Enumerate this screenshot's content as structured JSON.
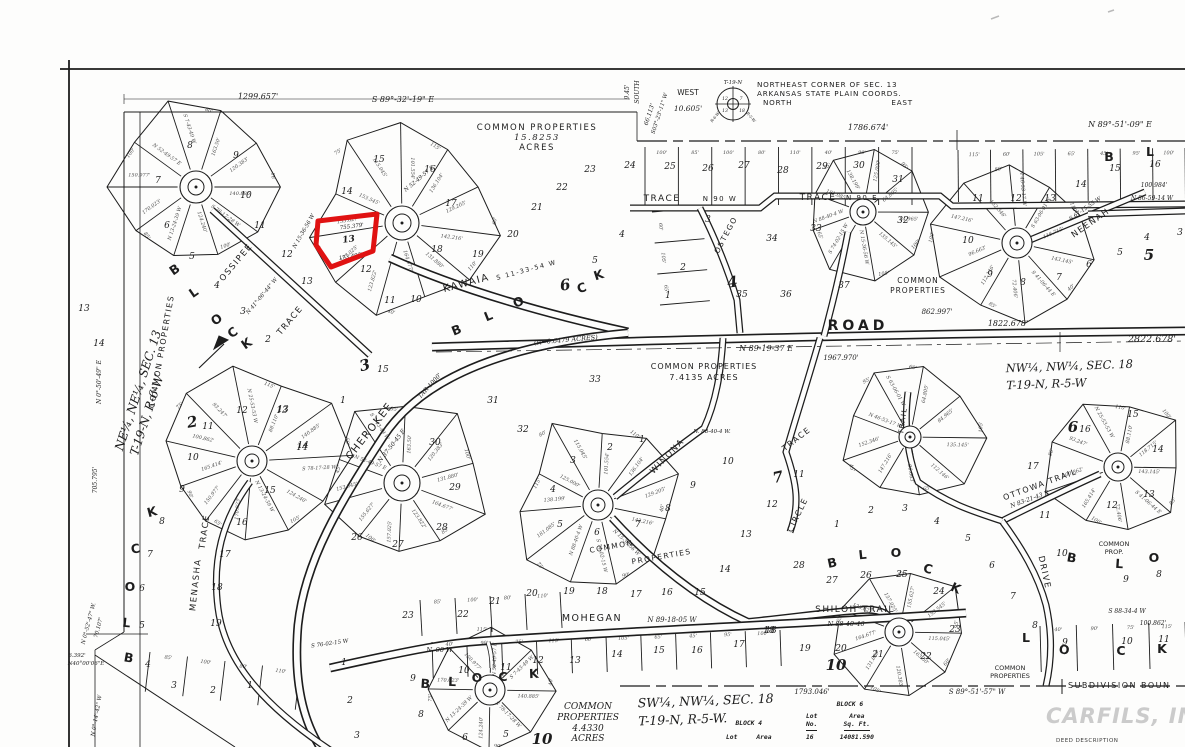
{
  "colors": {
    "paper": "#fdfdfc",
    "ink": "#1d1d1d",
    "highlight": "#e01212",
    "watermark": "#cbcbcb"
  },
  "corner_note": {
    "l1": "NORTHEAST CORNER OF SEC. 13",
    "l2": "ARKANSAS STATE PLAIN COORDS.",
    "north": "NORTH",
    "east": "EAST",
    "west": "WEST",
    "west_dim": "10.605'",
    "township": "T-19-N",
    "range_w": "R-6-W",
    "range_e": "R-5-W",
    "sec_nw": "12",
    "sec_ne": "7",
    "sec_sw": "13",
    "sec_se": "18"
  },
  "sections": {
    "ne": {
      "l1": "NE¼, NE¼, SEC. 13",
      "l2": "T-19-N, R-6-W"
    },
    "nw": {
      "l1": "NW¼, NW¼, SEC. 18",
      "l2": "T-19-N, R-5-W"
    },
    "sw": {
      "l1": "SW¼, NW¼, SEC. 18",
      "l2": "T-19-N, R-5-W."
    }
  },
  "common_properties": {
    "main": [
      "COMMON PROPERTIES",
      "15.8253",
      "ACRES"
    ],
    "mid": [
      "COMMON PROPERTIES",
      "7.4135 ACRES"
    ],
    "south": [
      "COMMON",
      "PROPERTIES",
      "4.4330",
      "ACRES"
    ],
    "block4": [
      "COMMON",
      "PROPERTIES"
    ],
    "right_small": [
      "COMMON",
      "PROP."
    ],
    "bottom_right": [
      "COMMON",
      "PROPERTIES"
    ]
  },
  "tables": {
    "block4": {
      "title": "BLOCK 4",
      "col_lot": "Lot",
      "col_area": "Area"
    },
    "block6": {
      "title": "BLOCK 6",
      "col_lot_1": "Lot",
      "col_lot_2": "No.",
      "col_area_1": "Area",
      "col_area_2": "Sq. Ft.",
      "row_no": "16",
      "row_area": "14081.590"
    }
  },
  "boundary": {
    "label": "SUBDIVISION BOUN"
  },
  "watermark": {
    "brand": "CARFILS, INC",
    "sub": "DEED DESCRIPTION"
  },
  "highlight": {
    "lot": "13",
    "color": "#e01212",
    "points": "318,221 377,214 373,251 331,267 316,245",
    "label_x": 349,
    "label_y": 242,
    "label_rot": -8
  },
  "map_texts": [
    {
      "t": "TRACE",
      "x": 662,
      "y": 201,
      "s": 9,
      "c": "st"
    },
    {
      "t": "N 90 W",
      "x": 720,
      "y": 201,
      "s": 7,
      "c": "st"
    },
    {
      "t": "TRACE",
      "x": 818,
      "y": 200,
      "s": 9,
      "c": "st"
    },
    {
      "t": "N 90 E",
      "x": 862,
      "y": 200,
      "s": 7,
      "c": "st"
    },
    {
      "t": "OSTEGO",
      "x": 728,
      "y": 236,
      "r": -62,
      "s": 7.5,
      "c": "st"
    },
    {
      "t": "KAWAIA",
      "x": 467,
      "y": 286,
      "r": -15,
      "s": 10,
      "c": "st"
    },
    {
      "t": "S 11-33-54 W",
      "x": 527,
      "y": 272,
      "r": -15,
      "s": 6.5,
      "c": "st"
    },
    {
      "t": "ROAD",
      "x": 858,
      "y": 330,
      "s": 14,
      "c": "stb"
    },
    {
      "t": "N 89-19-37 E",
      "x": 766,
      "y": 351,
      "s": 8,
      "c": "dim"
    },
    {
      "t": "CHEROKEE",
      "x": 372,
      "y": 433,
      "r": -52,
      "s": 10.5,
      "c": "st"
    },
    {
      "t": "N 37-50-45 E",
      "x": 393,
      "y": 447,
      "r": -52,
      "s": 6,
      "c": "dim"
    },
    {
      "t": "OSSIPEE",
      "x": 238,
      "y": 264,
      "r": -50,
      "s": 8.5,
      "c": "st"
    },
    {
      "t": "TRACE",
      "x": 292,
      "y": 322,
      "r": -50,
      "s": 8.5,
      "c": "st"
    },
    {
      "t": "MENASHA",
      "x": 198,
      "y": 585,
      "r": -84,
      "s": 8.5,
      "c": "st"
    },
    {
      "t": "TRACE",
      "x": 207,
      "y": 532,
      "r": -82,
      "s": 8.5,
      "c": "st"
    },
    {
      "t": "WINONA",
      "x": 669,
      "y": 458,
      "r": -46,
      "s": 8.5,
      "c": "st"
    },
    {
      "t": "TRACE",
      "x": 798,
      "y": 441,
      "r": -38,
      "s": 8,
      "c": "st"
    },
    {
      "t": "CIRCLE",
      "x": 800,
      "y": 516,
      "r": -64,
      "s": 8,
      "c": "st"
    },
    {
      "t": "TRAIL",
      "x": 905,
      "y": 421,
      "r": -82,
      "s": 7,
      "c": "st"
    },
    {
      "t": "NEENAH",
      "x": 1092,
      "y": 225,
      "r": -35,
      "s": 8.5,
      "c": "st"
    },
    {
      "t": "S 67-15-55 W",
      "x": 1086,
      "y": 210,
      "r": -35,
      "s": 5.5,
      "c": "dim"
    },
    {
      "t": "MOHEGAN",
      "x": 592,
      "y": 621,
      "s": 9.5,
      "c": "st"
    },
    {
      "t": "N 89-18-05 W",
      "x": 672,
      "y": 622,
      "s": 7,
      "c": "dim"
    },
    {
      "t": "SHILOH TRAIL",
      "x": 855,
      "y": 612,
      "s": 9,
      "c": "st"
    },
    {
      "t": "N 88-40-46",
      "x": 846,
      "y": 626,
      "s": 6.5,
      "c": "dim"
    },
    {
      "t": "OTTOWA TRAIL",
      "x": 1041,
      "y": 487,
      "r": -20,
      "s": 8,
      "c": "st"
    },
    {
      "t": "N 83-21-43 E",
      "x": 1030,
      "y": 501,
      "r": -20,
      "s": 6,
      "c": "dim"
    },
    {
      "t": "DRIVE",
      "x": 1042,
      "y": 573,
      "r": 78,
      "s": 8.5,
      "c": "st"
    },
    {
      "t": "1299.657'",
      "x": 258,
      "y": 99,
      "s": 8,
      "c": "dim"
    },
    {
      "t": "S 89°-32'-19\" E",
      "x": 403,
      "y": 102,
      "s": 8,
      "c": "dim"
    },
    {
      "t": "1786.674'",
      "x": 868,
      "y": 130,
      "s": 8,
      "c": "dim"
    },
    {
      "t": "N 89°-51'-09\" E",
      "x": 1120,
      "y": 127,
      "s": 8,
      "c": "dim"
    },
    {
      "t": "9.45'",
      "x": 629,
      "y": 92,
      "r": -90,
      "s": 6,
      "c": "dim"
    },
    {
      "t": "SOUTH",
      "x": 639,
      "y": 92,
      "r": -90,
      "s": 6,
      "c": "dim"
    },
    {
      "t": "66.113'",
      "x": 651,
      "y": 115,
      "r": -72,
      "s": 6,
      "c": "dim"
    },
    {
      "t": "S03°-23'-11\" W",
      "x": 661,
      "y": 114,
      "r": -72,
      "s": 5.5,
      "c": "dim"
    },
    {
      "t": "(R=0.6479 ACRES)",
      "x": 566,
      "y": 342,
      "r": -5,
      "s": 6.5,
      "c": "dim"
    },
    {
      "t": "862.997'",
      "x": 937,
      "y": 314,
      "s": 7,
      "c": "dim"
    },
    {
      "t": "1822.678'",
      "x": 1008,
      "y": 326,
      "s": 8,
      "c": "dim"
    },
    {
      "t": "2822.678'",
      "x": 1152,
      "y": 342,
      "s": 9.5,
      "c": "dim"
    },
    {
      "t": "1967.970'",
      "x": 841,
      "y": 360,
      "s": 7,
      "c": "dim"
    },
    {
      "t": "TAR-1000'",
      "x": 431,
      "y": 387,
      "r": -48,
      "s": 6,
      "c": "dim"
    },
    {
      "t": "N 86-59-14 W",
      "x": 1152,
      "y": 200,
      "s": 6,
      "c": "dim"
    },
    {
      "t": "100.984'",
      "x": 1154,
      "y": 187,
      "s": 6,
      "c": "dim"
    },
    {
      "t": "S 88-34-4 W",
      "x": 1127,
      "y": 613,
      "s": 6,
      "c": "dim"
    },
    {
      "t": "100.862'",
      "x": 1153,
      "y": 625,
      "s": 6,
      "c": "dim"
    },
    {
      "t": "1793.046'",
      "x": 812,
      "y": 694,
      "s": 7,
      "c": "dim"
    },
    {
      "t": "S 89°-51'-57\" W",
      "x": 977,
      "y": 694,
      "s": 7,
      "c": "dim"
    },
    {
      "t": "N 0°-50'-49\" E",
      "x": 101,
      "y": 382,
      "r": -90,
      "s": 6,
      "c": "dim"
    },
    {
      "t": "705.795'",
      "x": 97,
      "y": 480,
      "r": -90,
      "s": 6,
      "c": "dim"
    },
    {
      "t": "6.392'",
      "x": 77,
      "y": 657,
      "s": 5.5,
      "c": "dim"
    },
    {
      "t": "N40°00'06\"E",
      "x": 86,
      "y": 665,
      "s": 5.5,
      "c": "dim"
    },
    {
      "t": "N 0°-52'-47\" W.",
      "x": 90,
      "y": 624,
      "r": -75,
      "s": 5.5,
      "c": "dim"
    },
    {
      "t": "70.107'",
      "x": 100,
      "y": 628,
      "r": -75,
      "s": 5.5,
      "c": "dim"
    },
    {
      "t": "N 0°-14'-42\" W",
      "x": 98,
      "y": 716,
      "r": -80,
      "s": 5.5,
      "c": "dim"
    },
    {
      "t": "755.379'",
      "x": 352,
      "y": 228,
      "r": -7,
      "s": 5.5,
      "c": "dim"
    },
    {
      "t": "173.495'",
      "x": 351,
      "y": 258,
      "r": -9,
      "s": 5.5,
      "c": "dim"
    },
    {
      "t": "N. 90 W.",
      "x": 440,
      "y": 652,
      "s": 6.5,
      "c": "dim"
    },
    {
      "t": "S 76-02-15 W",
      "x": 330,
      "y": 645,
      "r": -8,
      "s": 5.5,
      "c": "dim"
    },
    {
      "t": "N 41°-06'-44\" W",
      "x": 263,
      "y": 297,
      "r": -50,
      "s": 5.5,
      "c": "dim"
    },
    {
      "t": "N 15-36-56 W",
      "x": 305,
      "y": 232,
      "r": -60,
      "s": 5.5,
      "c": "dim"
    },
    {
      "t": "N 52-49-57 E",
      "x": 420,
      "y": 180,
      "r": -40,
      "s": 5.5,
      "c": "dim"
    },
    {
      "t": "N. 88-40-4 W.",
      "x": 712,
      "y": 433,
      "s": 5.5,
      "c": "dim"
    },
    {
      "t": "COMMON",
      "x": 612,
      "y": 549,
      "r": -10,
      "s": 7.5,
      "c": "st"
    },
    {
      "t": "PROPERTIES",
      "x": 662,
      "y": 559,
      "r": -10,
      "s": 7.5,
      "c": "st"
    },
    {
      "t": "COMMON PROPERTIES",
      "x": 164,
      "y": 352,
      "r": -80,
      "s": 8,
      "c": "st"
    }
  ],
  "lot_numbers": [
    [
      8,
      190,
      148
    ],
    [
      9,
      236,
      158
    ],
    [
      7,
      158,
      183
    ],
    [
      10,
      246,
      198
    ],
    [
      6,
      167,
      228
    ],
    [
      11,
      260,
      228
    ],
    [
      5,
      192,
      259
    ],
    [
      12,
      287,
      257
    ],
    [
      4,
      217,
      288
    ],
    [
      13,
      307,
      284
    ],
    [
      3,
      243,
      314
    ],
    [
      2,
      268,
      342
    ],
    [
      13,
      84,
      311
    ],
    [
      14,
      99,
      346
    ],
    [
      15,
      379,
      162
    ],
    [
      16,
      430,
      172
    ],
    [
      14,
      347,
      194
    ],
    [
      17,
      451,
      206
    ],
    [
      12,
      366,
      272
    ],
    [
      18,
      437,
      252
    ],
    [
      11,
      390,
      303
    ],
    [
      19,
      478,
      257
    ],
    [
      20,
      513,
      237
    ],
    [
      21,
      537,
      210
    ],
    [
      22,
      562,
      190
    ],
    [
      23,
      590,
      172
    ],
    [
      10,
      416,
      302
    ],
    [
      4,
      622,
      237
    ],
    [
      5,
      595,
      263
    ],
    [
      24,
      630,
      168
    ],
    [
      25,
      670,
      169
    ],
    [
      26,
      708,
      171
    ],
    [
      27,
      744,
      168
    ],
    [
      28,
      783,
      173
    ],
    [
      29,
      822,
      169
    ],
    [
      30,
      859,
      168
    ],
    [
      31,
      898,
      182
    ],
    [
      34,
      772,
      241
    ],
    [
      33,
      816,
      231
    ],
    [
      32,
      903,
      223
    ],
    [
      35,
      742,
      297
    ],
    [
      36,
      786,
      297
    ],
    [
      37,
      844,
      288
    ],
    [
      3,
      708,
      222
    ],
    [
      2,
      683,
      270
    ],
    [
      1,
      668,
      298
    ],
    [
      11,
      978,
      201
    ],
    [
      12,
      1016,
      201
    ],
    [
      13,
      1050,
      201
    ],
    [
      14,
      1081,
      187
    ],
    [
      15,
      1115,
      171
    ],
    [
      16,
      1155,
      167
    ],
    [
      10,
      968,
      243
    ],
    [
      9,
      990,
      277
    ],
    [
      8,
      1023,
      285
    ],
    [
      7,
      1059,
      280
    ],
    [
      6,
      1089,
      267
    ],
    [
      5,
      1120,
      255
    ],
    [
      4,
      1147,
      240
    ],
    [
      3,
      1180,
      235
    ],
    [
      11,
      208,
      429
    ],
    [
      12,
      242,
      413
    ],
    [
      13,
      282,
      413
    ],
    [
      14,
      302,
      450
    ],
    [
      10,
      193,
      460
    ],
    [
      9,
      182,
      492
    ],
    [
      15,
      270,
      493
    ],
    [
      8,
      162,
      524
    ],
    [
      16,
      242,
      525
    ],
    [
      7,
      150,
      557
    ],
    [
      17,
      225,
      557
    ],
    [
      6,
      142,
      591
    ],
    [
      18,
      217,
      590
    ],
    [
      5,
      142,
      628
    ],
    [
      19,
      216,
      626
    ],
    [
      4,
      148,
      667
    ],
    [
      3,
      174,
      688
    ],
    [
      2,
      213,
      693
    ],
    [
      1,
      250,
      688
    ],
    [
      30,
      435,
      445
    ],
    [
      29,
      455,
      490
    ],
    [
      28,
      442,
      530
    ],
    [
      27,
      398,
      547
    ],
    [
      26,
      357,
      540
    ],
    [
      31,
      493,
      403
    ],
    [
      32,
      523,
      432
    ],
    [
      33,
      595,
      382
    ],
    [
      1,
      343,
      403
    ],
    [
      15,
      383,
      372
    ],
    [
      14,
      303,
      448
    ],
    [
      13,
      283,
      412
    ],
    [
      2,
      610,
      450
    ],
    [
      1,
      642,
      442
    ],
    [
      3,
      573,
      463
    ],
    [
      4,
      553,
      492
    ],
    [
      5,
      560,
      527
    ],
    [
      6,
      597,
      535
    ],
    [
      7,
      638,
      527
    ],
    [
      8,
      668,
      511
    ],
    [
      9,
      693,
      488
    ],
    [
      10,
      728,
      464
    ],
    [
      11,
      799,
      477
    ],
    [
      12,
      772,
      507
    ],
    [
      13,
      746,
      537
    ],
    [
      14,
      725,
      572
    ],
    [
      15,
      700,
      595
    ],
    [
      16,
      667,
      595
    ],
    [
      17,
      636,
      597
    ],
    [
      18,
      602,
      594
    ],
    [
      19,
      569,
      594
    ],
    [
      20,
      532,
      596
    ],
    [
      21,
      495,
      604
    ],
    [
      22,
      463,
      617
    ],
    [
      23,
      408,
      618
    ],
    [
      1,
      837,
      527
    ],
    [
      2,
      871,
      513
    ],
    [
      3,
      905,
      511
    ],
    [
      4,
      937,
      524
    ],
    [
      5,
      968,
      541
    ],
    [
      6,
      992,
      568
    ],
    [
      7,
      1013,
      599
    ],
    [
      8,
      1035,
      628
    ],
    [
      28,
      799,
      568
    ],
    [
      27,
      832,
      583
    ],
    [
      26,
      866,
      578
    ],
    [
      25,
      902,
      577
    ],
    [
      24,
      939,
      594
    ],
    [
      23,
      955,
      632
    ],
    [
      22,
      926,
      659
    ],
    [
      21,
      878,
      657
    ],
    [
      20,
      841,
      651
    ],
    [
      19,
      805,
      651
    ],
    [
      18,
      771,
      633
    ],
    [
      15,
      1133,
      417
    ],
    [
      16,
      1085,
      432
    ],
    [
      14,
      1158,
      452
    ],
    [
      17,
      1033,
      469
    ],
    [
      13,
      1149,
      497
    ],
    [
      12,
      1112,
      508
    ],
    [
      11,
      1045,
      518
    ],
    [
      10,
      1062,
      556
    ],
    [
      9,
      1126,
      582
    ],
    [
      8,
      1159,
      577
    ],
    [
      11,
      506,
      670
    ],
    [
      12,
      538,
      663
    ],
    [
      13,
      575,
      663
    ],
    [
      14,
      617,
      657
    ],
    [
      15,
      659,
      653
    ],
    [
      16,
      697,
      653
    ],
    [
      17,
      739,
      647
    ],
    [
      18,
      769,
      633
    ],
    [
      10,
      464,
      673
    ],
    [
      9,
      413,
      681
    ],
    [
      8,
      421,
      717
    ],
    [
      6,
      465,
      740
    ],
    [
      5,
      506,
      737
    ],
    [
      1,
      344,
      665
    ],
    [
      2,
      350,
      703
    ],
    [
      3,
      357,
      738
    ],
    [
      9,
      1065,
      645
    ],
    [
      10,
      1127,
      644
    ],
    [
      11,
      1164,
      642
    ]
  ],
  "block_letters": [
    [
      "B",
      177,
      273,
      -35
    ],
    [
      "L",
      196,
      296,
      -35
    ],
    [
      "O",
      219,
      323,
      -35
    ],
    [
      "C",
      235,
      336,
      -35
    ],
    [
      "K",
      249,
      347,
      -35
    ],
    [
      "K",
      153,
      516,
      -15
    ],
    [
      "C",
      136,
      553,
      -8
    ],
    [
      "O",
      130,
      591,
      0
    ],
    [
      "L",
      126,
      627,
      6
    ],
    [
      "B",
      128,
      662,
      10
    ],
    [
      "B",
      425,
      688,
      4
    ],
    [
      "L",
      452,
      686,
      2
    ],
    [
      "O",
      477,
      682,
      0
    ],
    [
      "C",
      503,
      681,
      0
    ],
    [
      "K",
      534,
      678,
      -2
    ],
    [
      "B",
      833,
      567,
      -12
    ],
    [
      "L",
      863,
      559,
      -6
    ],
    [
      "O",
      896,
      557,
      0
    ],
    [
      "C",
      927,
      573,
      14
    ],
    [
      "K",
      954,
      592,
      24
    ],
    [
      "B",
      1071,
      562,
      10
    ],
    [
      "L",
      1119,
      568,
      4
    ],
    [
      "O",
      1154,
      562,
      0
    ],
    [
      "L",
      1026,
      642,
      0
    ],
    [
      "O",
      1064,
      654,
      4
    ],
    [
      "C",
      1121,
      655,
      0
    ],
    [
      "K",
      1162,
      653,
      0
    ],
    [
      "B",
      458,
      334,
      -22
    ],
    [
      "L",
      490,
      320,
      -22
    ],
    [
      "O",
      520,
      306,
      -22
    ],
    [
      "C",
      583,
      292,
      -18
    ],
    [
      "K",
      600,
      279,
      -18
    ],
    [
      "B",
      1109,
      161,
      0
    ],
    [
      "L",
      1150,
      156,
      0
    ]
  ],
  "block_numbers": [
    [
      "3",
      366,
      370,
      -15
    ],
    [
      "4",
      733,
      287,
      -8
    ],
    [
      "5",
      1149,
      260,
      0
    ],
    [
      "6",
      1073,
      432,
      0
    ],
    [
      "6",
      566,
      290,
      -10
    ],
    [
      "7",
      779,
      482,
      -12
    ],
    [
      "10",
      836,
      670,
      0
    ],
    [
      "10",
      542,
      744,
      0
    ],
    [
      "2",
      193,
      427,
      -10
    ]
  ],
  "annotations": [
    "140.885'",
    "S 78-17-28 W",
    "124.240'",
    "N 13-24-39 W",
    "170.023'",
    "150.977'",
    "N 52-49-57 E",
    "S 7-43-49 W",
    "163.50'",
    "120.383'",
    "131.880'",
    "164.677'",
    "123.822'",
    "157.025'",
    "155.627'",
    "153.545'",
    "115.045'",
    "101.554'",
    "136.104'",
    "129.205'",
    "142.216'",
    "N 15-36-56 W",
    "S 74-02-15 W",
    "N 88-40-4 W",
    "181.085'",
    "138.199'",
    "125.000'",
    "64.805'",
    "84.965'",
    "135.145'",
    "112.146'",
    "96.663'",
    "147.216'",
    "152.346'",
    "N 46-53-17 W",
    "S 63-06-01 W",
    "118.715'",
    "143.145'",
    "S 41-06-44 E",
    "72.406'",
    "165.414'",
    "100.862'",
    "93.247'",
    "N 25-53-53 W",
    "88.110'"
  ],
  "row_dims": [
    "95'",
    "100'",
    "85'",
    "100'",
    "80'",
    "110'",
    "40'",
    "90'",
    "75'",
    "115'",
    "60'",
    "105'",
    "65'",
    "45'"
  ]
}
